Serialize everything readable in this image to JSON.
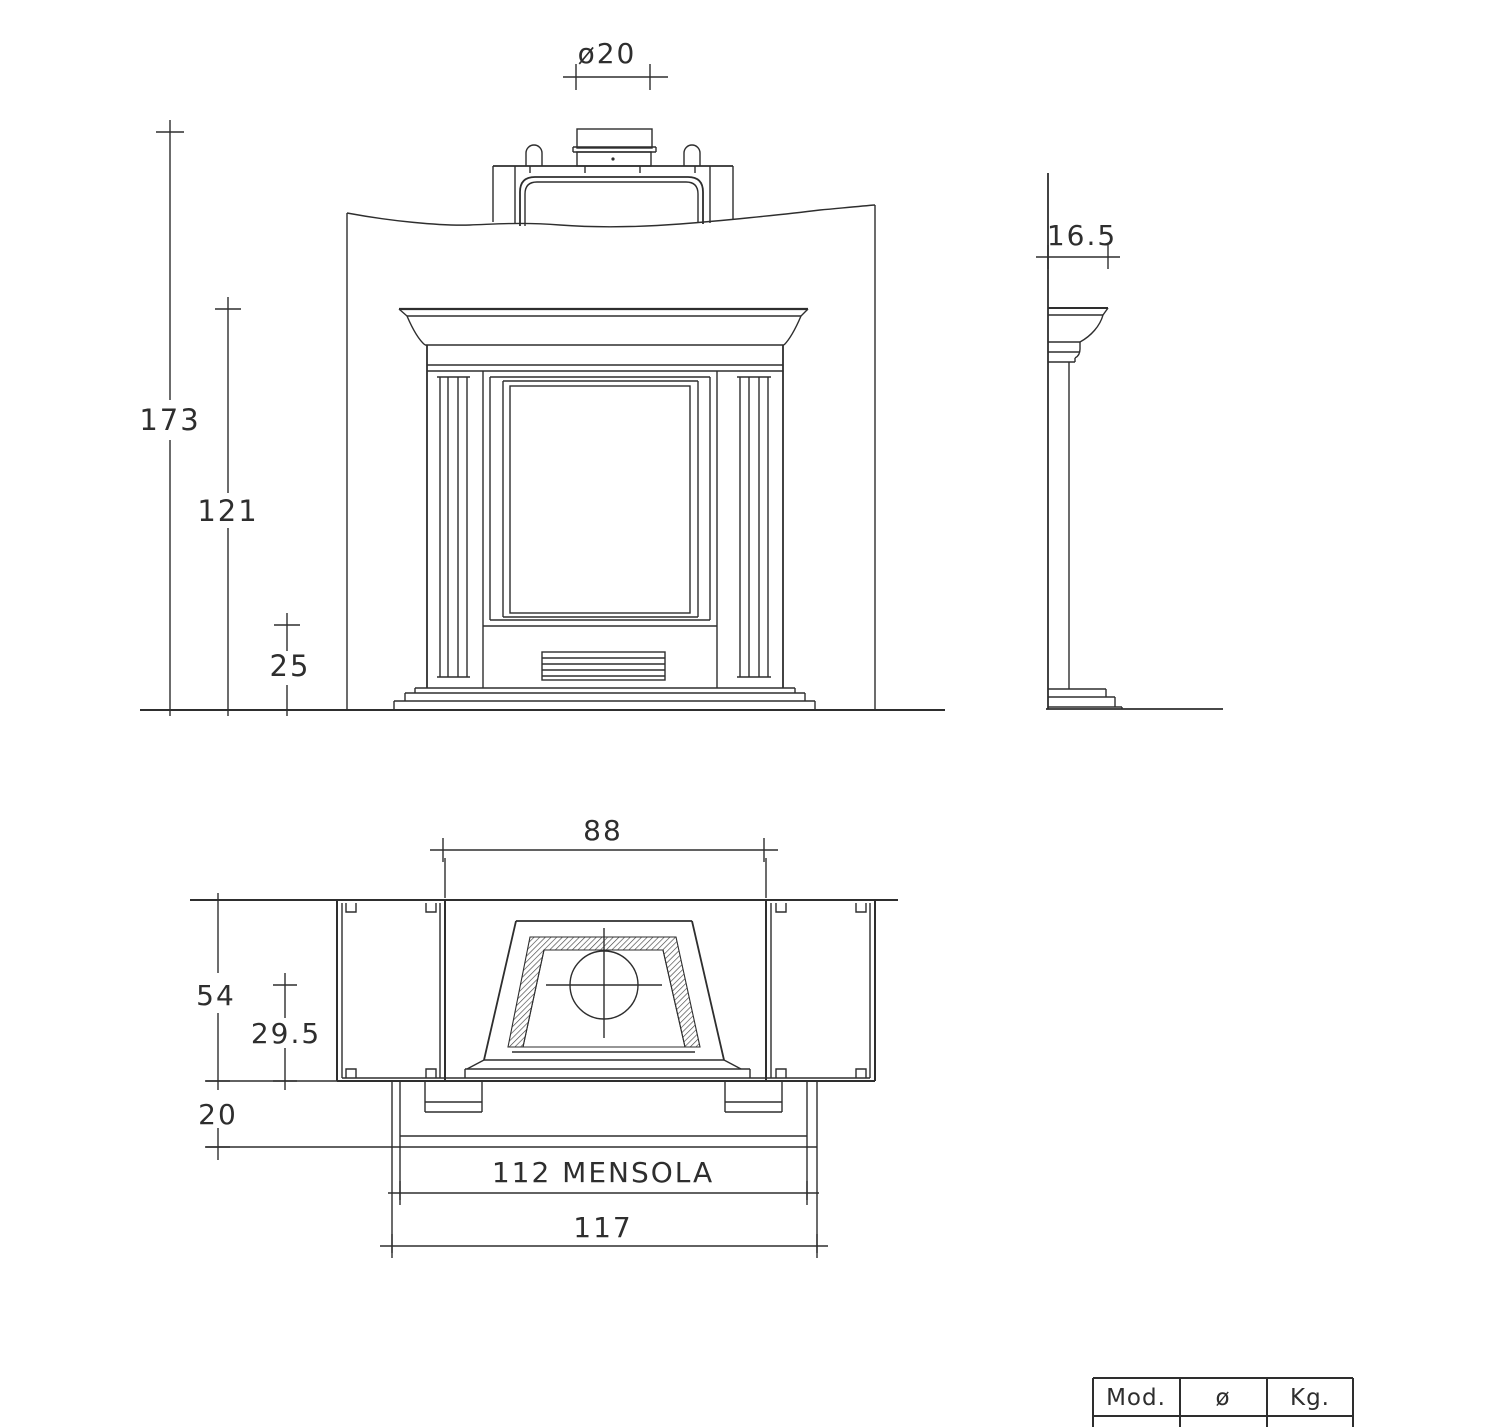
{
  "drawing": {
    "title": "Fireplace technical drawing",
    "colors": {
      "line": "#2e2e2e",
      "thin_line": "#3a3a3a",
      "background": "#ffffff"
    },
    "front_view": {
      "flue_diameter_label": "ø20",
      "total_height": "173",
      "mantel_height": "121",
      "hearth_height": "25"
    },
    "side_view": {
      "top_depth": "16.5"
    },
    "plan_view": {
      "opening_width": "88",
      "wall_depth": "54",
      "firebox_depth": "29.5",
      "shelf_overhang": "20",
      "shelf_width_label": "112  MENSOLA",
      "overall_width": "117"
    },
    "title_table": {
      "headers": [
        "Mod.",
        "ø",
        "Kg."
      ],
      "row": [
        "",
        "",
        ""
      ]
    }
  }
}
